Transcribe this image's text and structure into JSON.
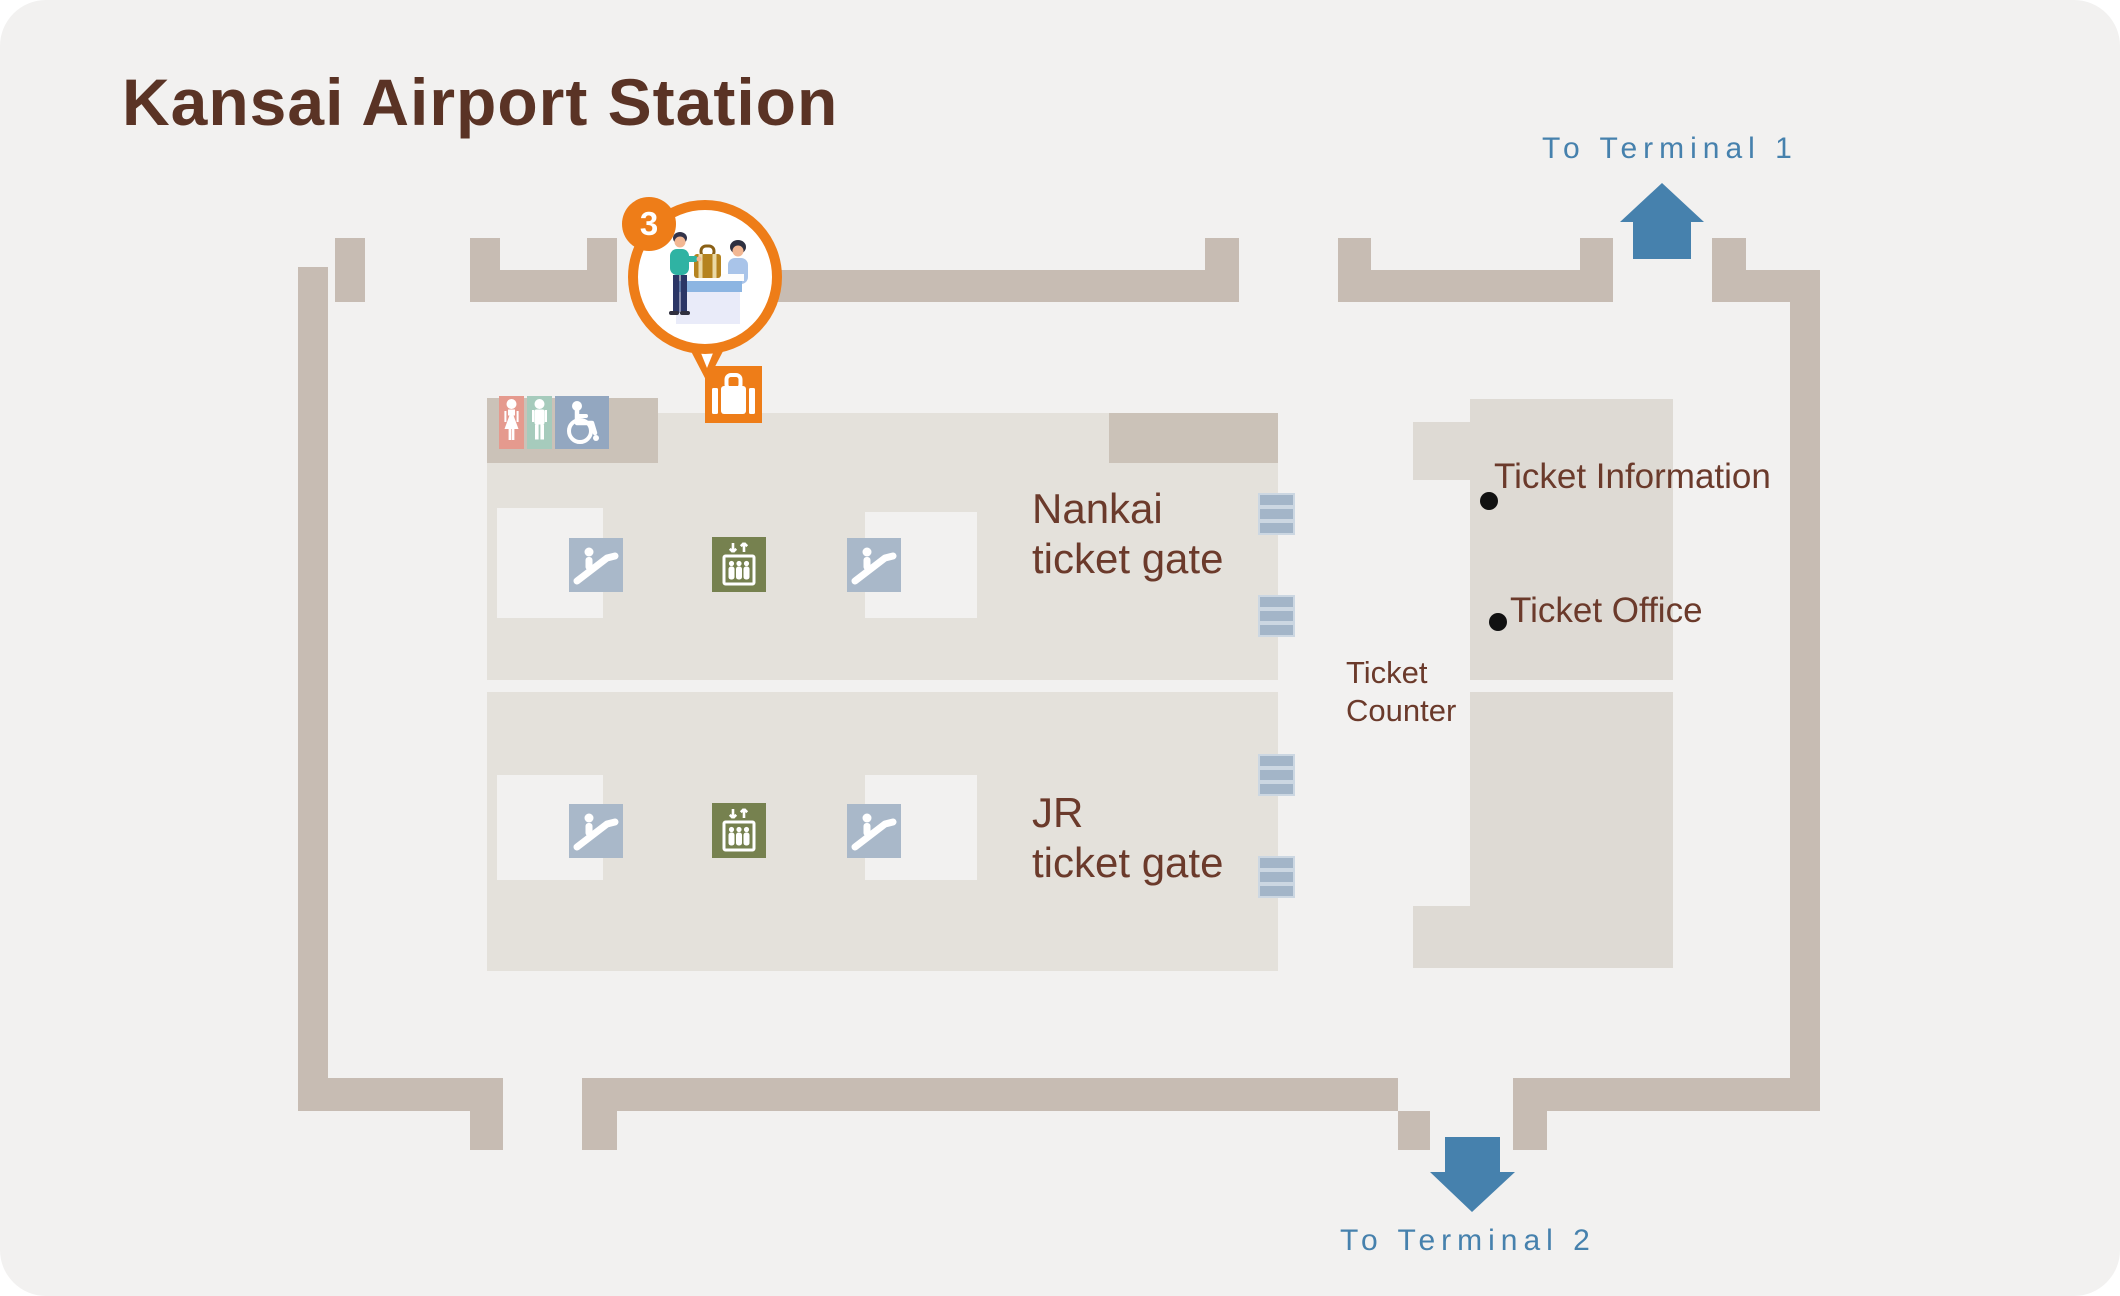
{
  "title": "Kansai Airport Station",
  "badge": {
    "number": "3"
  },
  "directions": {
    "terminal1": {
      "label": "To Terminal 1"
    },
    "terminal2": {
      "label": "To Terminal 2"
    }
  },
  "gates": {
    "nankai": {
      "line1": "Nankai",
      "line2": "ticket gate"
    },
    "jr": {
      "line1": "JR",
      "line2": "ticket gate"
    }
  },
  "counter": {
    "label_line1": "Ticket",
    "label_line2": "Counter",
    "points": [
      {
        "label": "Ticket Information"
      },
      {
        "label": "Ticket Office"
      }
    ]
  },
  "icons": {
    "luggage": "luggage-counter-icon",
    "escalator": "escalator-icon",
    "elevator": "elevator-icon",
    "restroom_women": "women-restroom-icon",
    "restroom_men": "men-restroom-icon",
    "accessible": "wheelchair-accessible-icon"
  },
  "colors": {
    "background": "#f2f1f0",
    "wall": "#c7bcb3",
    "floor": "#e4e1db",
    "dark_block": "#cbc2b8",
    "counter_area": "#dedad4",
    "accent_orange": "#ee7d18",
    "accent_blue": "#4681ad",
    "title_brown": "#5a3325",
    "label_brown": "#6b3a2b",
    "escalator_bg": "#a9b8c9",
    "elevator_bg": "#76814f",
    "gate_bar": "#a3b5c8",
    "women_pink": "#e59a8e",
    "men_teal": "#a6cbbc",
    "accessible_blue": "#93a7c0"
  }
}
